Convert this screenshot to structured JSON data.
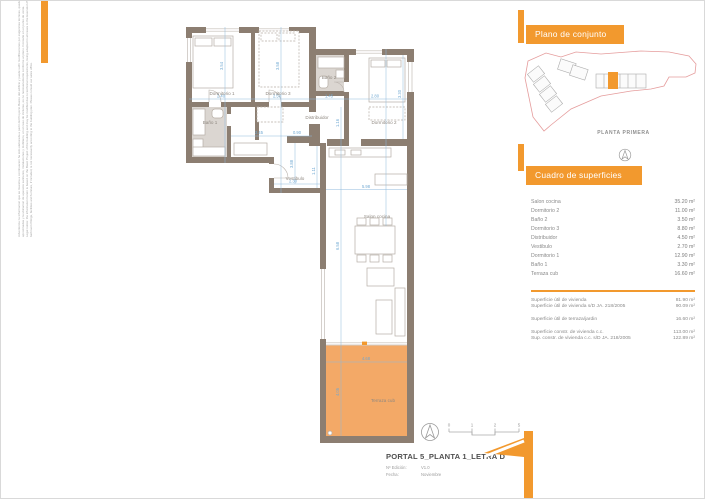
{
  "brand": {
    "orange": "#F2992E",
    "terrace_fill": "#F3A967",
    "wall": "#8C7E71",
    "dim_blue": "#8FB9DC",
    "site_red": "#E59C9C"
  },
  "disclaimer": {
    "line1": "Advertencia: la informacion que se muestra a continuacion ha sido elaborada a partir del Proyecto Basico del edificio y puede sufrir modificaciones por exigencias tecnicas, quedandose en todo caso al Proyecto de Ejecucion. Las superficies son",
    "line2": "aproximadas y la ubicacion de aparatos sanitarios, instalaciones y mobiliario, en el caso de incluirse, es no necesariamente conforme al plano. Consulte en el punto de venta.",
    "line3": "Legal notice: the information herein is based on the Basic Project of the building and may be modified due to technical requirements, being adapted in all cases to the Execution Project. The surface areas are approximate and the location of",
    "line4": "bathroom fittings, facilities and furniture, if included, is not necessarily according to the building plan. Please consult our sales office."
  },
  "site": {
    "title": "Plano de conjunto",
    "caption": "PLANTA PRIMERA"
  },
  "surfaces": {
    "title": "Cuadro de superficies",
    "rows": [
      {
        "label": "Salon cocina",
        "value": "35.20 m²"
      },
      {
        "label": "Dormitorio 2",
        "value": "11.00 m²"
      },
      {
        "label": "Baño 2",
        "value": "3.50 m²"
      },
      {
        "label": "Dormitorio 3",
        "value": "8.80 m²"
      },
      {
        "label": "Distribuidor",
        "value": "4.50 m²"
      },
      {
        "label": "Vestibulo",
        "value": "2.70 m²"
      },
      {
        "label": "Dormitorio 1",
        "value": "12.90 m²"
      },
      {
        "label": "Baño 1",
        "value": "3.30 m²"
      },
      {
        "label": "Terraza cub",
        "value": "16.60 m²"
      }
    ],
    "summary": [
      {
        "label": "Superficie útil de vivienda",
        "value": "81.90 m²"
      },
      {
        "label": "Superficie útil de vivienda s/D JA. 218/2005",
        "value": "90.09 m²"
      },
      {
        "label": "Superficie útil de terraza/jardin",
        "value": "16.60 m²"
      },
      {
        "label": "Superficie constr. de vivienda c.c.",
        "value": "113.00 m²"
      },
      {
        "label": "Sup. constr. de vivienda c.c. s/D JA. 218/2005",
        "value": "122.89 m²"
      }
    ]
  },
  "footer": {
    "title": "PORTAL 5_PLANTA 1_LETRA D",
    "edition_label": "Nº Edición:",
    "edition_value": "V1.0",
    "date_label": "Fecha:",
    "date_value": "Noviembre",
    "scale_ticks": [
      "0",
      "1",
      "2",
      "5"
    ]
  },
  "plan": {
    "rooms": [
      {
        "label": "Dormitorio 1"
      },
      {
        "label": "Dormitorio 3"
      },
      {
        "label": "Baño 2"
      },
      {
        "label": "Dormitorio 2"
      },
      {
        "label": "Baño 1"
      },
      {
        "label": "Distribuidor"
      },
      {
        "label": "Vestibulo"
      },
      {
        "label": "Salon cocina"
      },
      {
        "label": "Terraza cub"
      }
    ],
    "dims": [
      {
        "text": "2.40"
      },
      {
        "text": "2.50"
      },
      {
        "text": "1.45"
      },
      {
        "text": "2.80"
      },
      {
        "text": "2.45"
      },
      {
        "text": "0.90"
      },
      {
        "text": "2.30"
      },
      {
        "text": "5.98"
      },
      {
        "text": "4.68"
      },
      {
        "text": "3.54"
      },
      {
        "text": "3.58"
      },
      {
        "text": "3.30"
      },
      {
        "text": "1.16"
      },
      {
        "text": "1.11"
      },
      {
        "text": "3.88"
      },
      {
        "text": "6.58"
      },
      {
        "text": "4.05"
      }
    ]
  }
}
